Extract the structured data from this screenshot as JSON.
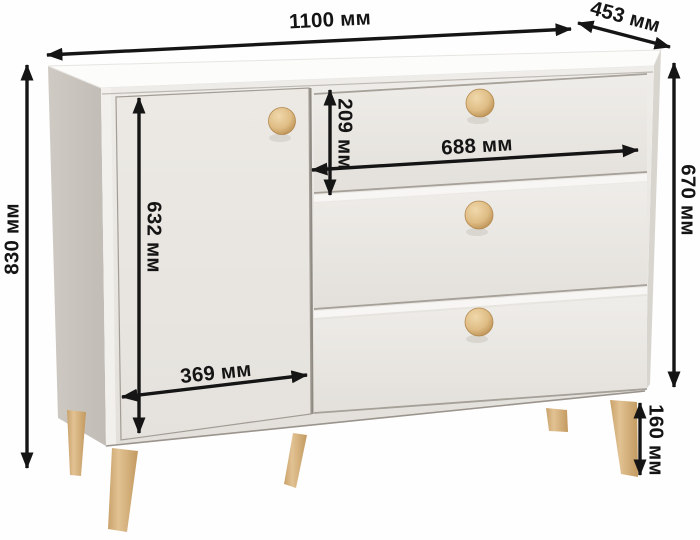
{
  "figure": {
    "type": "furniture-dimension-diagram",
    "subject": "chest-of-drawers with door, three drawers and wooden legs",
    "unit": "мм"
  },
  "dimensions": {
    "overall_width": {
      "label": "1100 мм"
    },
    "overall_depth": {
      "label": "453 мм"
    },
    "overall_height": {
      "label": "830 мм"
    },
    "body_height": {
      "label": "670 мм"
    },
    "drawer_height": {
      "label": "209 мм"
    },
    "drawer_width": {
      "label": "688 мм"
    },
    "door_height": {
      "label": "632 мм"
    },
    "door_width": {
      "label": "369 мм"
    },
    "leg_height": {
      "label": "160 мм"
    }
  },
  "colors": {
    "annotation": "#141414",
    "background": "#fefefe",
    "cabinet_top": "#fcfcfb",
    "cabinet_front": "#e8e5e1",
    "cabinet_side": "#c8c3bc",
    "wood": "#dcba89"
  }
}
